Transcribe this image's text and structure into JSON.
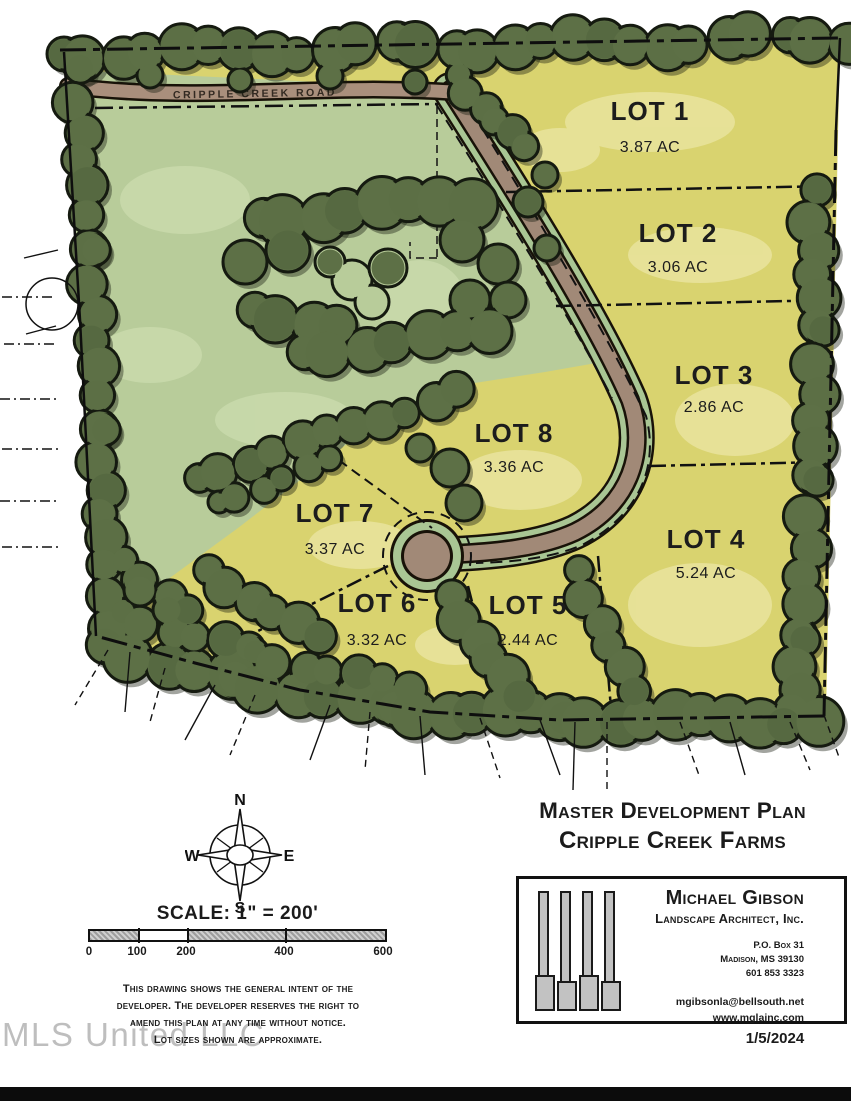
{
  "map": {
    "road_label": "CRIPPLE CREEK ROAD",
    "lots": [
      {
        "name": "LOT 1",
        "acreage": "3.87 AC"
      },
      {
        "name": "LOT 2",
        "acreage": "3.06 AC"
      },
      {
        "name": "LOT 3",
        "acreage": "2.86 AC"
      },
      {
        "name": "LOT 4",
        "acreage": "5.24 AC"
      },
      {
        "name": "LOT 5",
        "acreage": "2.44 AC"
      },
      {
        "name": "LOT 6",
        "acreage": "3.32 AC"
      },
      {
        "name": "LOT 7",
        "acreage": "3.37 AC"
      },
      {
        "name": "LOT 8",
        "acreage": "3.36 AC"
      }
    ]
  },
  "compass": {
    "n": "N",
    "e": "E",
    "s": "S",
    "w": "W"
  },
  "scale": {
    "label": "SCALE: 1\" = 200'",
    "ticks": [
      "0",
      "100",
      "200",
      "400",
      "600"
    ]
  },
  "disclaimer": {
    "lines": [
      "This drawing shows the general intent of the",
      "developer.  The developer reserves the right to",
      "amend this plan at any time without notice.",
      "Lot sizes shown are approximate."
    ]
  },
  "title": {
    "line1": "Master Development Plan",
    "line2": "Cripple Creek Farms"
  },
  "title_block": {
    "firm_name": "Michael Gibson",
    "firm_subtitle": "Landscape Architect, Inc.",
    "address": [
      "P.O. Box 31",
      "Madison, MS 39130",
      "601 853 3323"
    ],
    "contact": [
      "mgibsonla@bellsouth.net",
      "www.mglainc.com"
    ],
    "date": "1/5/2024"
  },
  "watermark": "MLS United LLC",
  "colors": {
    "lot_fill": "#d9d36f",
    "pasture": "#b8cc9a",
    "tree": "#5b6e45",
    "road": "#a18977",
    "road_verge": "#a9c694"
  }
}
